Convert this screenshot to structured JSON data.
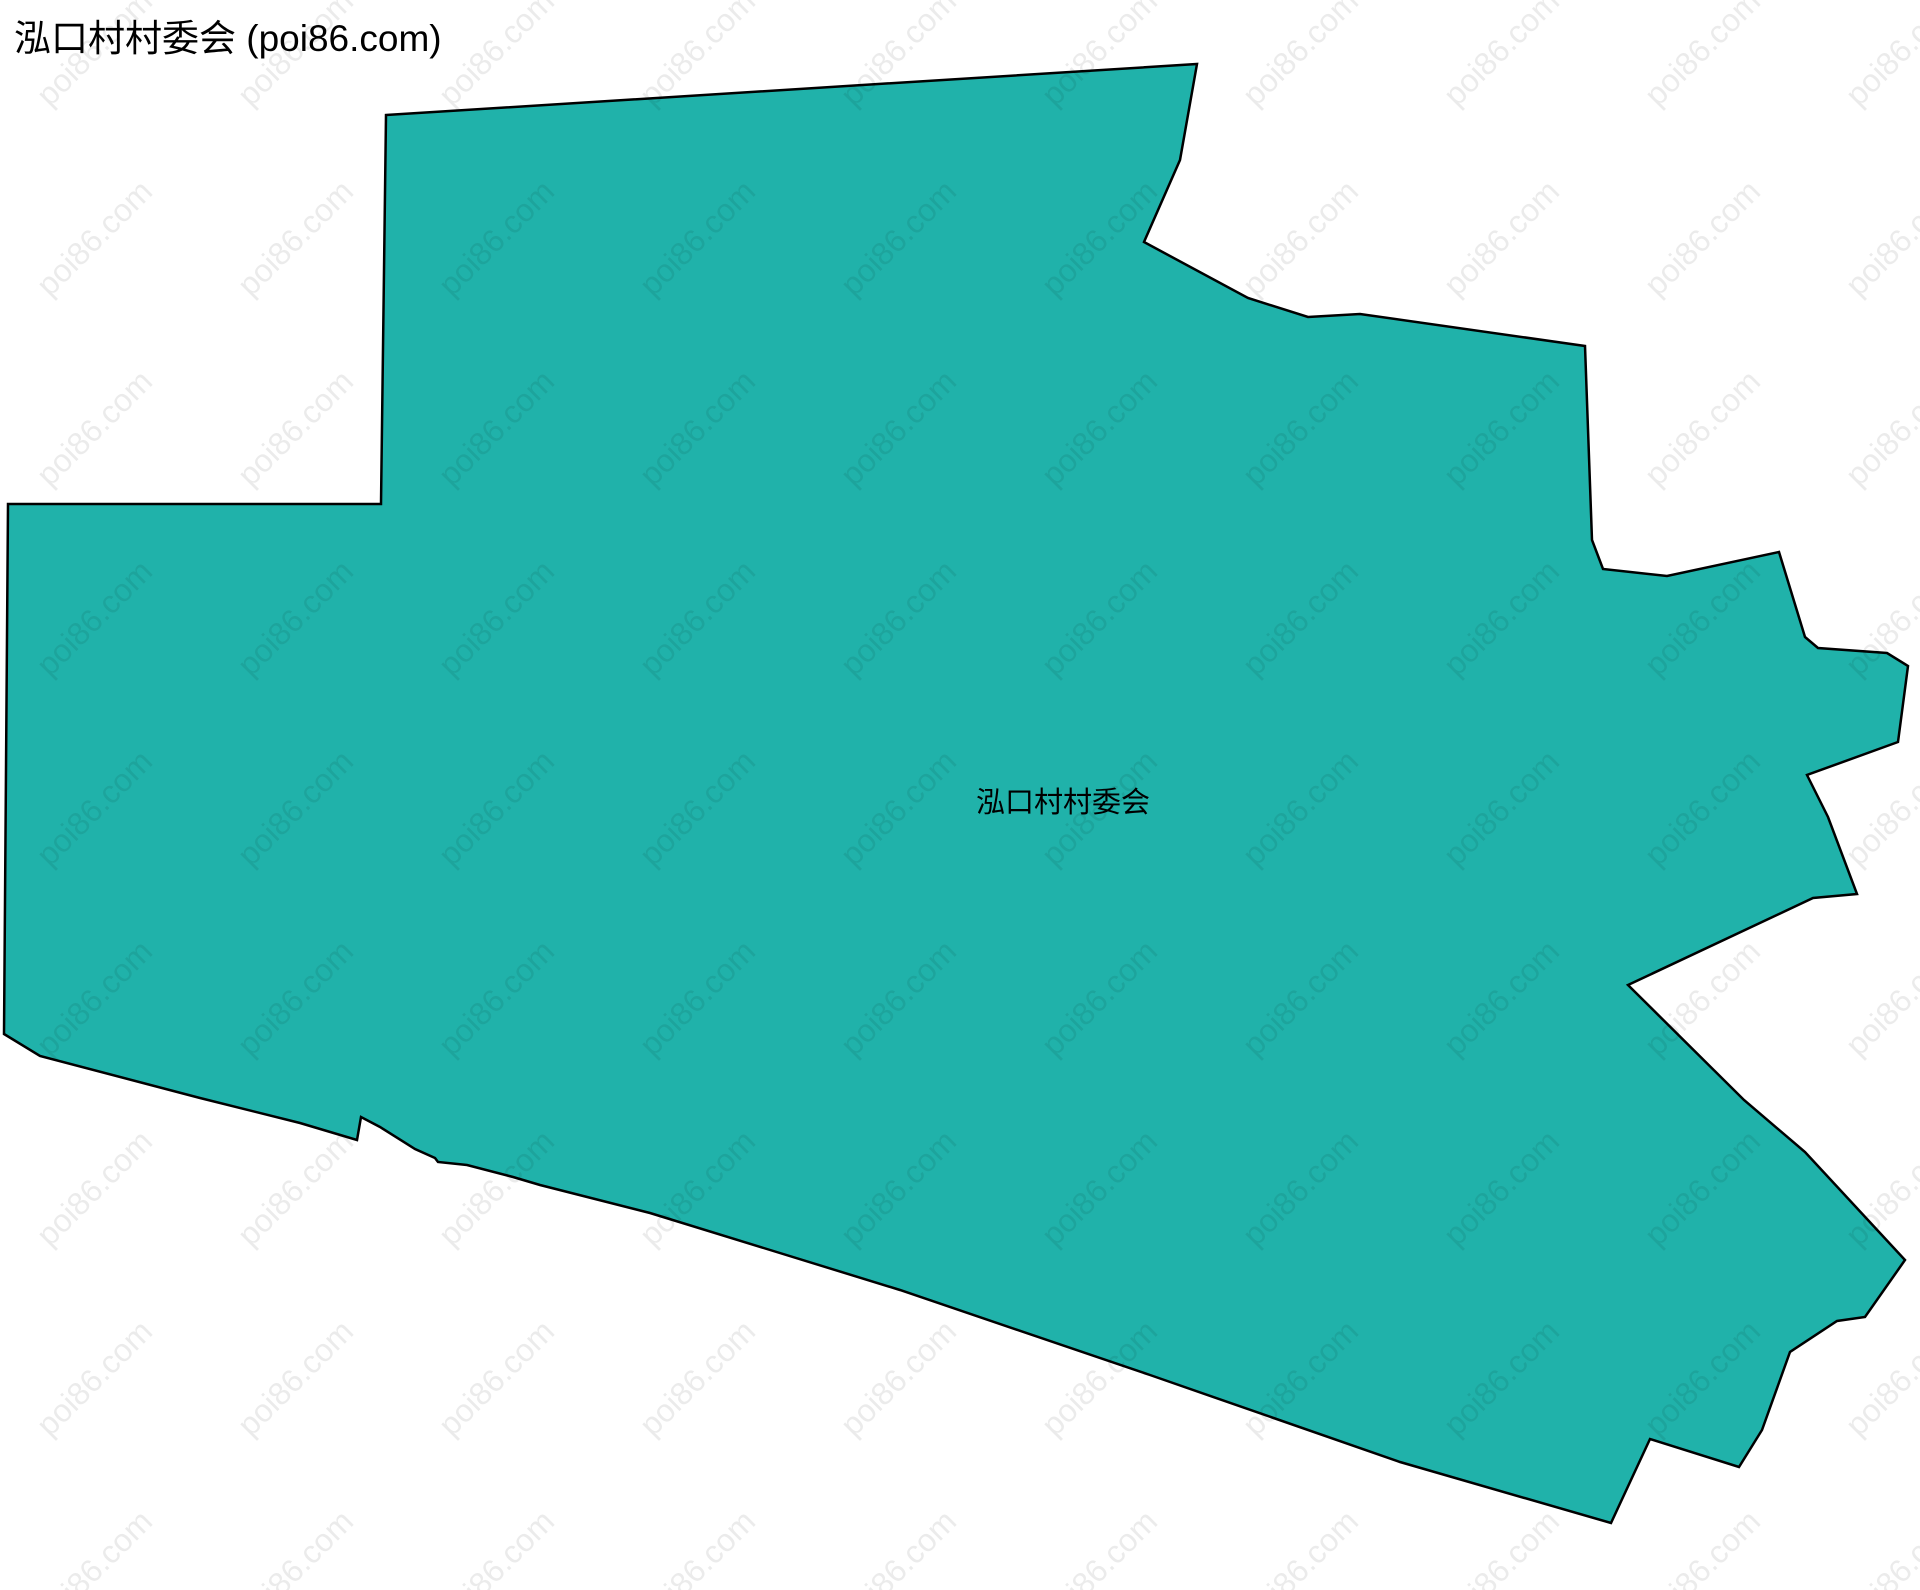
{
  "title": "泓口村村委会 (poi86.com)",
  "watermark": {
    "text": "poi86.com",
    "color": "rgba(0,0,0,0.08)"
  },
  "colors": {
    "background": "#ffffff",
    "region_fill": "#20b2aa",
    "region_stroke": "#000000",
    "title_color": "#000000",
    "label_color": "#000000"
  },
  "map_data": {
    "type": "polygon",
    "region_name": "泓口村村委会",
    "points": [
      [
        386,
        115
      ],
      [
        1197,
        64
      ],
      [
        1180,
        160
      ],
      [
        1144,
        242
      ],
      [
        1248,
        298
      ],
      [
        1308,
        317
      ],
      [
        1360,
        314
      ],
      [
        1585,
        346
      ],
      [
        1592,
        540
      ],
      [
        1603,
        569
      ],
      [
        1667,
        576
      ],
      [
        1779,
        552
      ],
      [
        1805,
        637
      ],
      [
        1818,
        648
      ],
      [
        1887,
        653
      ],
      [
        1908,
        666
      ],
      [
        1898,
        742
      ],
      [
        1807,
        775
      ],
      [
        1828,
        817
      ],
      [
        1857,
        894
      ],
      [
        1813,
        898
      ],
      [
        1628,
        985
      ],
      [
        1744,
        1100
      ],
      [
        1805,
        1152
      ],
      [
        1905,
        1260
      ],
      [
        1865,
        1317
      ],
      [
        1837,
        1321
      ],
      [
        1790,
        1352
      ],
      [
        1762,
        1430
      ],
      [
        1739,
        1467
      ],
      [
        1650,
        1439
      ],
      [
        1611,
        1523
      ],
      [
        1400,
        1462
      ],
      [
        1150,
        1375
      ],
      [
        900,
        1290
      ],
      [
        650,
        1213
      ],
      [
        540,
        1185
      ],
      [
        513,
        1177
      ],
      [
        467,
        1165
      ],
      [
        438,
        1162
      ],
      [
        435,
        1158
      ],
      [
        415,
        1149
      ],
      [
        380,
        1127
      ],
      [
        361,
        1117
      ],
      [
        357,
        1140
      ],
      [
        300,
        1123
      ],
      [
        200,
        1098
      ],
      [
        40,
        1056
      ],
      [
        4,
        1034
      ],
      [
        8,
        504
      ],
      [
        381,
        504
      ]
    ],
    "label": {
      "text": "泓口村村委会",
      "x": 1063,
      "y": 800
    }
  }
}
